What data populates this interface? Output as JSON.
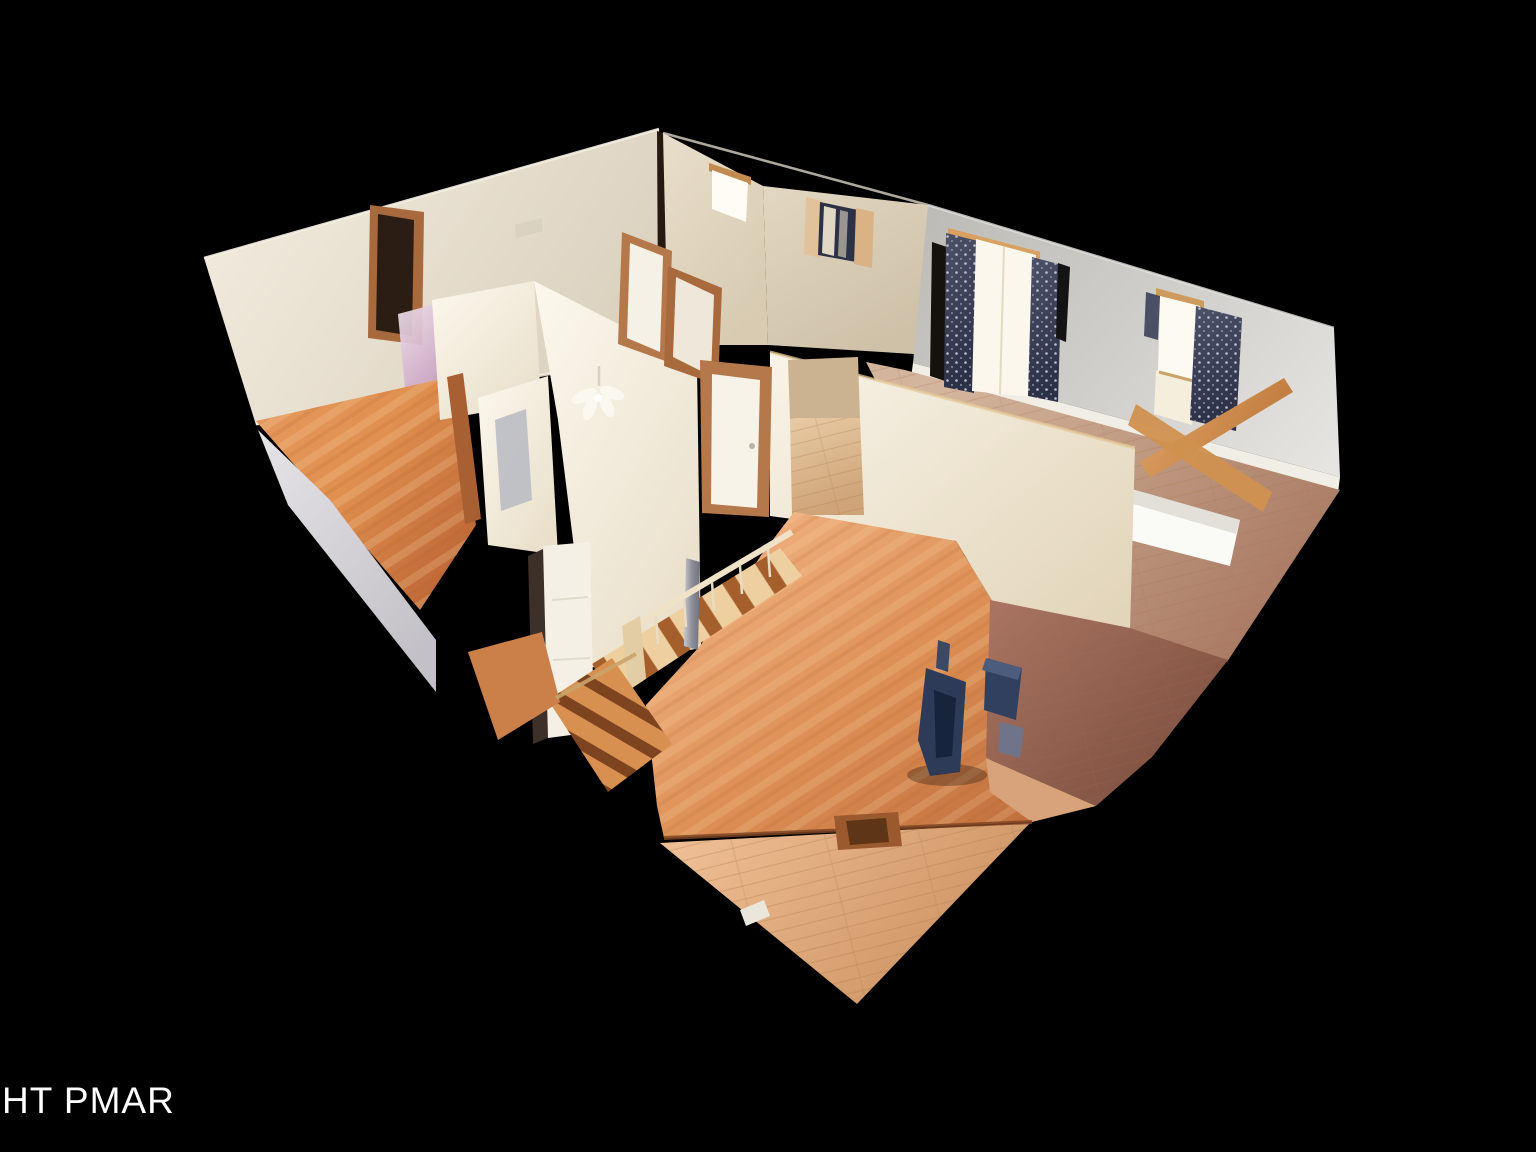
{
  "scene": {
    "description": "3D dollhouse cutaway view of a house interior floating on a black background",
    "background_color": "#000000"
  },
  "watermark": {
    "text": "HT PMAR",
    "color": "#ffffff"
  },
  "palette": {
    "wall_cream": "#e9e0d0",
    "wall_bright": "#f9f4e8",
    "wall_gray": "#cfcdc8",
    "floor_wood_orange": "#d4854f",
    "floor_wood_light": "#e0b287",
    "floor_bedroom": "#b98a70",
    "floor_dark_brown": "#96614d",
    "carpet_gray": "#d9d7da",
    "curtain_navy": "#3a4058",
    "trim_wood": "#b5784a",
    "window_glow": "#fdfaf0",
    "stove_blue": "#2d3a58"
  }
}
